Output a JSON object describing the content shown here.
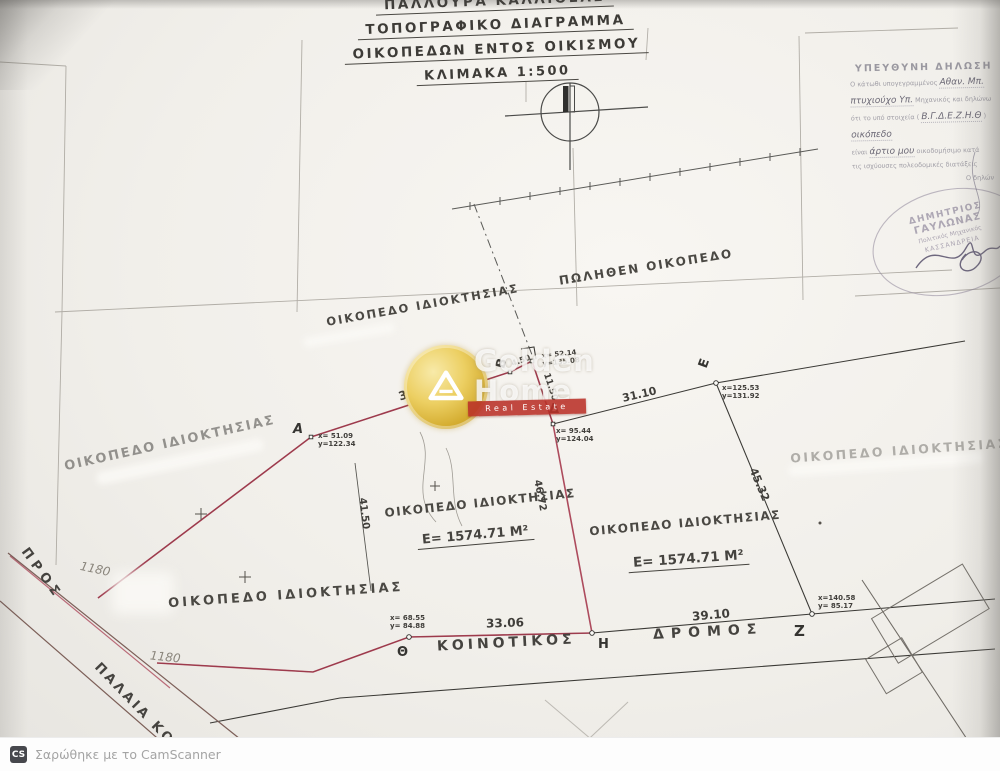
{
  "titles": {
    "location": "ΠΑΛΛΟΥΡΑ ΚΑΛΛΙΘΕΑΣ",
    "line1": "ΤΟΠΟΓΡΑΦΙΚΟ ΔΙΑΓΡΑΜΜΑ",
    "line2": "ΟΙΚΟΠΕΔΩΝ ΕΝΤΟΣ ΟΙΚΙΣΜΟΥ",
    "scale": "ΚΛΙΜΑΚΑ 1:500"
  },
  "declaration": {
    "heading": "ΥΠΕΥΘΥΝΗ ΔΗΛΩΣΗ",
    "l1": "Ο κάτωθι υπογεγραμμένος",
    "l1h": "Αθαν. Μπ.",
    "l2h": "πτυχιούχο Υπ.",
    "l2": "Μηχανικός και δηλώνω",
    "l3": "ότι το υπό στοιχεία (",
    "l3h": "Β.Γ.Δ.Ε.Ζ.Η.Θ",
    "l3b": ")",
    "l4h": "οικόπεδο",
    "l5": "είναι",
    "l5h": "άρτιο μου",
    "l5b": "οικοδομήσιμο κατά",
    "l6": "τις ισχύουσες πολεοδομικές διατάξεις",
    "l7": "Ο δηλών"
  },
  "stamp": {
    "name1": "ΔΗΜΗΤΡΙΟΣ",
    "name2": "ΓΑΥΛΩΝΑΣ",
    "title": "Πολιτικός Μηχανικός",
    "city": "ΚΑΣΣΑΝΔΡΕΙΑ"
  },
  "labels": {
    "parcel": "ΟΙΚΟΠΕΔΟ ΙΔΙΟΚΤΗΣΙΑΣ",
    "sold": "ΠΩΛΗΘΕΝ ΟΙΚΟΠΕΔΟ",
    "area": "Ε= 1574.71 Μ²",
    "road1": "ΚΟΙΝΟΤΙΚΟΣ",
    "road2": "ΔΡΟΜΟΣ",
    "pros": "ΠΡΟΣ",
    "old_road": "ΠΑΛΑΙΑ ΚΟΙΝΟΤ",
    "hand_number": "1180"
  },
  "measurements": {
    "ab": "38.46",
    "bg": "4.50",
    "gd": "11.50",
    "de": "31.10",
    "ez": "45.32",
    "zh": "39.10",
    "hth": "33.06",
    "inner": "41.50",
    "dh": "46.72"
  },
  "points": {
    "a": {
      "label": "Α",
      "cx": "x= 51.09",
      "cy": "y=122.34"
    },
    "b": {
      "label": "Β"
    },
    "g": {
      "cx": "x= 52.14",
      "cy": "y=135.08"
    },
    "d": {
      "label": "Δ",
      "cx": "x= 95.44",
      "cy": "y=124.04"
    },
    "e": {
      "label": "Ε",
      "cx": "x=125.53",
      "cy": "y=131.92"
    },
    "z": {
      "label": "Ζ",
      "cx": "x=140.58",
      "cy": "y= 85.17"
    },
    "h": {
      "label": "Η"
    },
    "th": {
      "label": "Θ",
      "cx": "x= 68.55",
      "cy": "y= 84.88"
    }
  },
  "watermark": {
    "word1": "Golden",
    "word2": "Home",
    "banner": "Real Estate"
  },
  "footer": {
    "badge": "CS",
    "text": "Σαρώθηκε με το CamScanner"
  },
  "colors": {
    "boundary_red": "#a63a4e",
    "line_dark": "#3a3935",
    "gold": "#d3ab2e"
  }
}
